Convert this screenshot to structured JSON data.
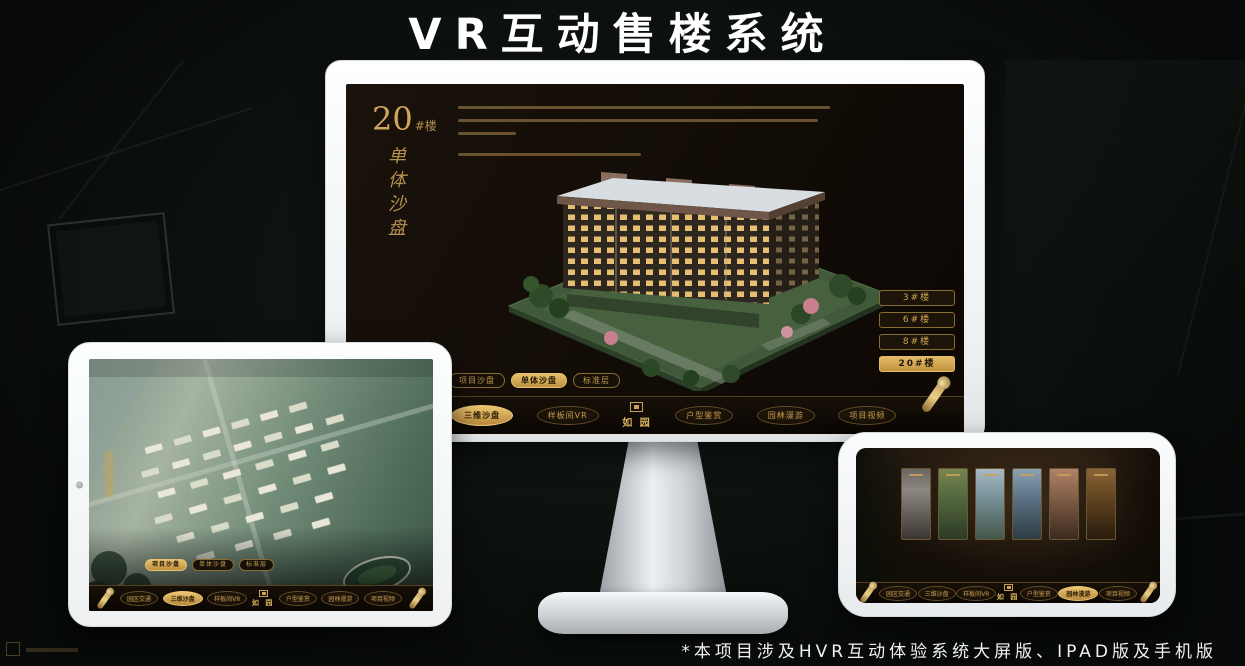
{
  "title": "VR互动售楼系统",
  "footnote": "*本项目涉及HVR互动体验系统大屏版、IPAD版及手机版",
  "brand": {
    "logo_text": "如 园"
  },
  "colors": {
    "gold": "#c59a4e",
    "gold_active": "#e6c06c",
    "screen_bg": "#17100a",
    "title_color": "#ffffff"
  },
  "monitor": {
    "hero": {
      "big": "20",
      "small": "#楼",
      "vertical": "单体沙盘"
    },
    "floor_buttons": [
      {
        "label": "3#楼",
        "active": false
      },
      {
        "label": "6#楼",
        "active": false
      },
      {
        "label": "8#楼",
        "active": false
      },
      {
        "label": "20#楼",
        "active": true
      }
    ],
    "view_tabs": [
      {
        "label": "项目沙盘",
        "active": false
      },
      {
        "label": "单体沙盘",
        "active": true
      },
      {
        "label": "标准层",
        "active": false
      }
    ],
    "nav_items": [
      {
        "label": "园区交通",
        "active": false
      },
      {
        "label": "三维沙盘",
        "active": true
      },
      {
        "label": "样板间VR",
        "active": false
      },
      {
        "label": "户型鉴赏",
        "active": false
      },
      {
        "label": "园林漫游",
        "active": false
      },
      {
        "label": "项目视频",
        "active": false
      }
    ]
  },
  "tablet": {
    "view_tabs": [
      {
        "label": "项目沙盘",
        "active": true
      },
      {
        "label": "单体沙盘",
        "active": false
      },
      {
        "label": "标准层",
        "active": false
      }
    ],
    "nav_items": [
      {
        "label": "园区交通",
        "active": false
      },
      {
        "label": "三维沙盘",
        "active": true
      },
      {
        "label": "样板间VR",
        "active": false
      },
      {
        "label": "户型鉴赏",
        "active": false
      },
      {
        "label": "园林漫游",
        "active": false
      },
      {
        "label": "项目视频",
        "active": false
      }
    ]
  },
  "phone": {
    "nav_items": [
      {
        "label": "园区交通",
        "active": false
      },
      {
        "label": "三维沙盘",
        "active": false
      },
      {
        "label": "样板间VR",
        "active": false
      },
      {
        "label": "户型鉴赏",
        "active": false
      },
      {
        "label": "园林漫游",
        "active": true
      },
      {
        "label": "项目视频",
        "active": false
      }
    ]
  }
}
